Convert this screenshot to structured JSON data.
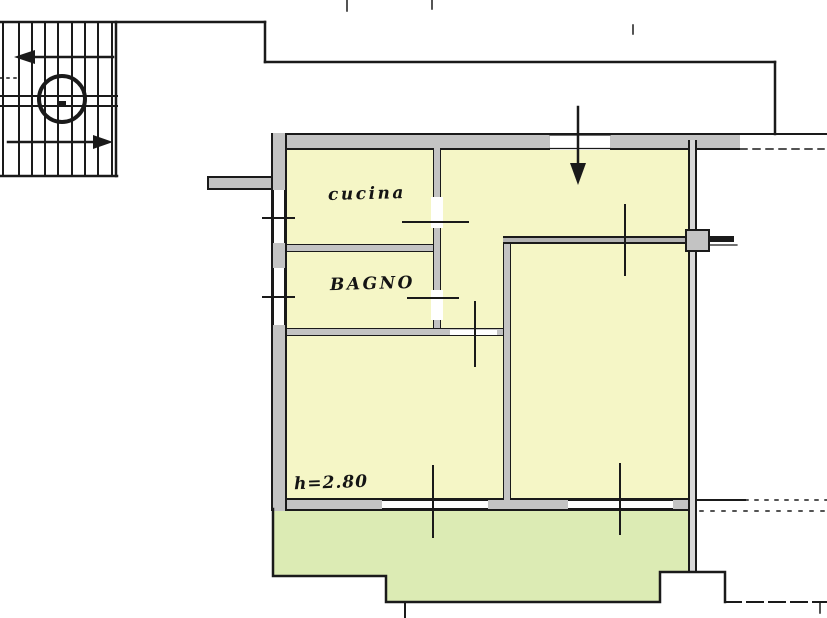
{
  "floor_plan": {
    "room_labels": {
      "kitchen": "cucina",
      "bathroom": "BAGNO"
    },
    "annotations": {
      "ceiling_height": "h=2.80"
    },
    "colors": {
      "background": "#ffffff",
      "room_fill": "#f5f6c6",
      "balcony_fill": "#dcebb4",
      "wall_fill": "#c3c3c3",
      "wall_fill_dark": "#b2b2b2",
      "line": "#1a1a1a"
    }
  }
}
